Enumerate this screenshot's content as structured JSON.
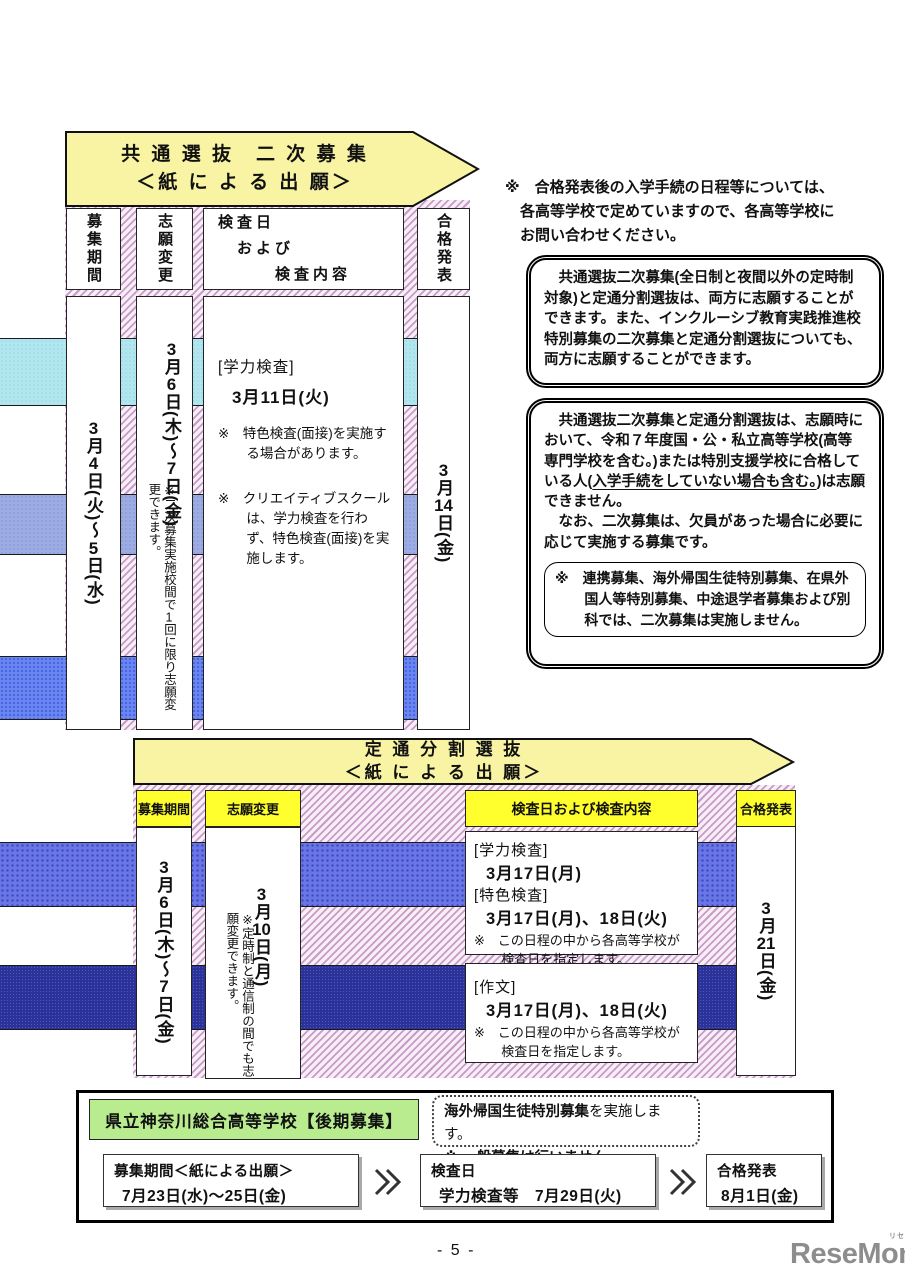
{
  "colors": {
    "banner_yellow": "#f8f4a4",
    "header_yellow": "#ffff2e",
    "green_box": "#b9ec8f",
    "band_cyan": "#b2e6ef",
    "band_periwinkle": "#9cabe2",
    "band_blue": "#6b86f0",
    "band_blue2": "#6a76e5",
    "band_navy": "#2b3298",
    "hatch_stripe": "#c79cc7",
    "logo_gray": "#8d8d8d"
  },
  "banner1": {
    "title": "共 通 選 抜　二 次 募 集",
    "subtitle": "＜紙 に よ る 出 願＞"
  },
  "table1": {
    "headers": {
      "col1": "募集期間",
      "col2": "志願変更",
      "col3": "検査日\n　および\n　　　検査内容",
      "col4": "合格発表"
    },
    "col1_date": "3月4日(火)～5日(水)",
    "col2_date": "3月6日(木)～7日(金)",
    "col2_note": "※二次募集実施校間で1回に限り志願変更できます。",
    "col3": {
      "exam_label": "[学力検査]",
      "exam_date": "3月11日(火)",
      "note1": "※　特色検査(面接)を実施する場合があります。",
      "note2": "※　クリエイティブスクールは、学力検査を行わず、特色検査(面接)を実施します。"
    },
    "col4_date": "3月14日(金)"
  },
  "sidebar": {
    "top_note": "※　合格発表後の入学手続の日程等については、\n　各高等学校で定めていますので、各高等学校に\n　お問い合わせください。",
    "box1": "　共通選抜二次募集(全日制と夜間以外の定時制対象)と定通分割選抜は、両方に志願することができます。また、インクルーシブ教育実践推進校特別募集の二次募集と定通分割選抜についても、両方に志願することができます。",
    "box2": {
      "seg1": "　共通選抜二次募集と定通分割選抜は、志願時において、令和７年度国・公・私立高等学校(高等専門学校を含む。)または特別支援学校に合格している人(",
      "seg2": "入学手続をしていない場合も含む。",
      "seg3": ")は志願できません。",
      "para2": "　なお、二次募集は、欠員があった場合に必要に応じて実施する募集です。",
      "inner_note": "※　連携募集、海外帰国生徒特別募集、在県外国人等特別募集、中途退学者募集および別科では、二次募集は実施しません。"
    }
  },
  "banner2": {
    "title": "定 通 分 割 選 抜",
    "subtitle": "＜紙 に よ る 出 願＞"
  },
  "table2": {
    "headers": {
      "col1": "募集期間",
      "col2": "志願変更",
      "col3": "検査日および検査内容",
      "col4": "合格発表"
    },
    "col1_date": "3月6日(木)～7日(金)",
    "col2_date": "3月10日(月)",
    "col2_note": "※定時制と通信制の間でも志願変更できます。",
    "box_a": {
      "label1": "[学力検査]",
      "date1": "3月17日(月)",
      "label2": "[特色検査]",
      "date2": "3月17日(月)、18日(火)",
      "note": "※　この日程の中から各高等学校が検査日を指定します。"
    },
    "box_b": {
      "label1": "[作文]",
      "date1": "3月17日(月)、18日(火)",
      "note": "※　この日程の中から各高等学校が検査日を指定します。"
    },
    "col4_date": "3月21日(金)"
  },
  "bottom": {
    "school_label": "県立神奈川総合高等学校【後期募集】",
    "note_bold": "海外帰国生徒特別募集",
    "note_rest": "を実施します。",
    "note_line2": "※ 一般募集は行いません。",
    "step1_title": "募集期間＜紙による出願＞",
    "step1_date": "7月23日(水)～25日(金)",
    "step2_title": "検査日",
    "step2_date": "学力検査等　7月29日(火)",
    "step3_title": "合格発表",
    "step3_date": "8月1日(金)"
  },
  "footer": {
    "page_number": "- 5 -",
    "logo_text": "ReseMom.",
    "logo_ruby": "リセマム"
  }
}
